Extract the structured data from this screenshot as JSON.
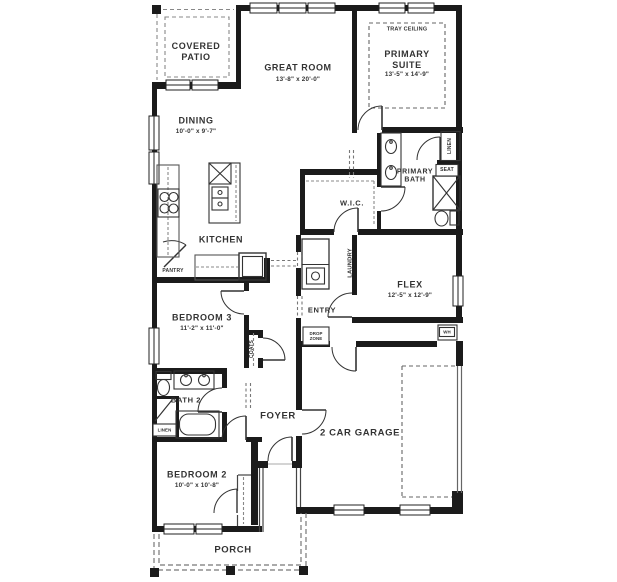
{
  "plan": {
    "rooms": [
      {
        "id": "covered-patio",
        "label": "COVERED\nPATIO",
        "dims": null
      },
      {
        "id": "great-room",
        "label": "GREAT ROOM",
        "dims": "13'-8\" x 20'-0\""
      },
      {
        "id": "primary-suite",
        "label": "PRIMARY\nSUITE",
        "dims": "13'-5\" x 14'-9\""
      },
      {
        "id": "dining",
        "label": "DINING",
        "dims": "10'-0\" x 9'-7\""
      },
      {
        "id": "kitchen",
        "label": "KITCHEN",
        "dims": null
      },
      {
        "id": "wic",
        "label": "W.I.C.",
        "dims": null
      },
      {
        "id": "primary-bath",
        "label": "PRIMARY\nBATH",
        "dims": null
      },
      {
        "id": "flex",
        "label": "FLEX",
        "dims": "12'-5\" x 12'-9\""
      },
      {
        "id": "entry",
        "label": "ENTRY",
        "dims": null
      },
      {
        "id": "bedroom-3",
        "label": "BEDROOM 3",
        "dims": "11'-2\" x 11'-0\""
      },
      {
        "id": "bath-2",
        "label": "BATH 2",
        "dims": null
      },
      {
        "id": "foyer",
        "label": "FOYER",
        "dims": null
      },
      {
        "id": "bedroom-2",
        "label": "BEDROOM 2",
        "dims": "10'-0\" x 10'-8\""
      },
      {
        "id": "garage",
        "label": "2 CAR GARAGE",
        "dims": null
      },
      {
        "id": "porch",
        "label": "PORCH",
        "dims": null
      }
    ],
    "features": {
      "tray_ceiling": "TRAY CEILING",
      "pantry": "PANTRY",
      "laundry": "LAUNDRY",
      "coats": "COATS",
      "linen_primary": "LINEN",
      "linen_hall": "LINEN",
      "seat": "SEAT",
      "drop_zone": "DROP\nZONE",
      "water_heater": "WH"
    },
    "colors": {
      "wall": "#1b1b1b",
      "text": "#333333",
      "dash": "#888888"
    }
  }
}
